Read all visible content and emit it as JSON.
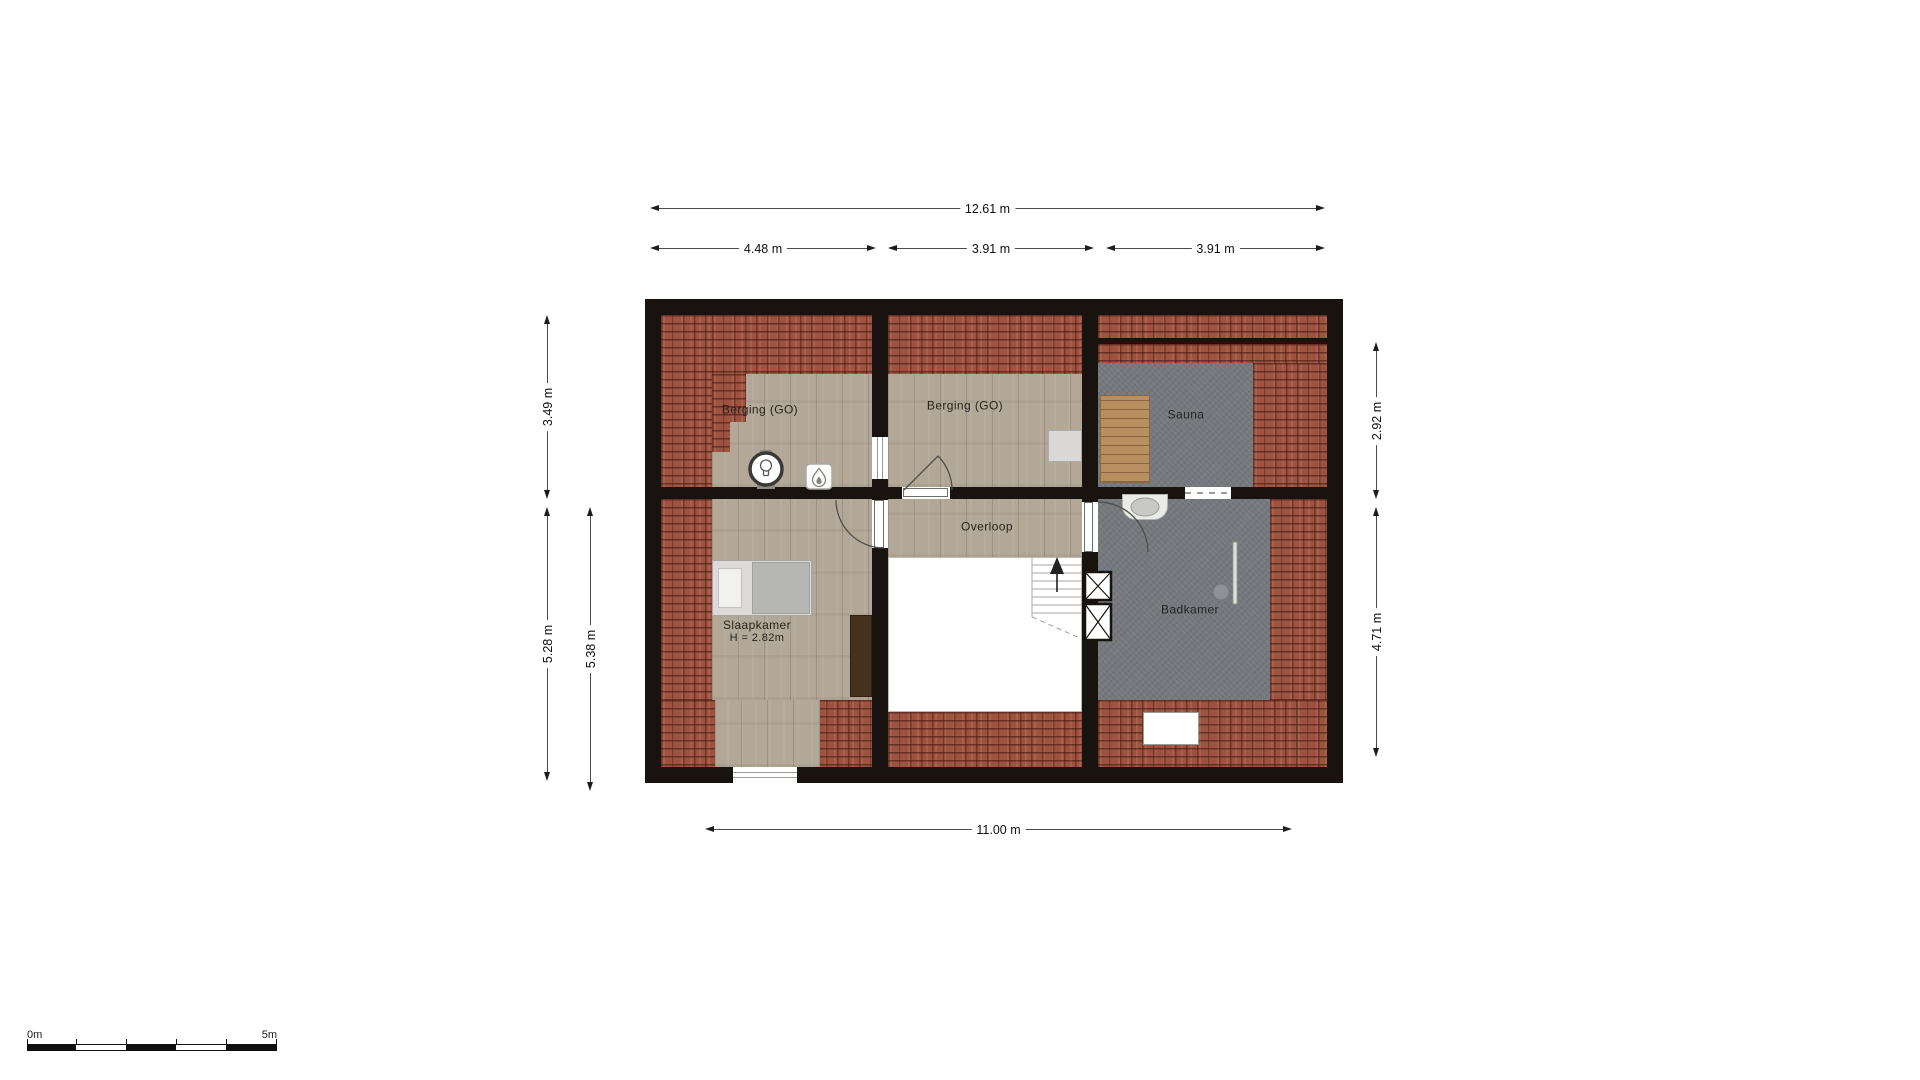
{
  "plan": {
    "type": "floorplan-attic-level",
    "dims": {
      "top_total": "12.61 m",
      "top_seg_1": "4.48 m",
      "top_seg_2": "3.91 m",
      "top_seg_3": "3.91 m",
      "left_1": "3.49 m",
      "left_2": "5.28 m",
      "left_3": "5.38 m",
      "right_1": "2.92 m",
      "right_2": "4.71 m",
      "bottom": "11.00 m"
    },
    "rooms": {
      "berging_left": "Berging (GO)",
      "berging_mid": "Berging (GO)",
      "sauna": "Sauna",
      "overloop": "Overloop",
      "slaapkamer": "Slaapkamer",
      "slaapkamer_height": "H = 2.82m",
      "badkamer": "Badkamer"
    },
    "scale_bar": {
      "start_label": "0m",
      "end_label": "5m"
    },
    "icons": [
      "mech-vent-unit-icon",
      "boiler-flame-icon",
      "stairs-up-arrow-icon",
      "washbasin-icon",
      "shower-icon",
      "duct-shaft-x-icon"
    ],
    "colors": {
      "wall": "#18130f",
      "roof_tiles": "#9d5340",
      "wood_floor": "#b3a898",
      "wet_room_floor": "#75787c",
      "sauna_bench": "#b78f60",
      "dimension_line": "#4a4a4a"
    }
  }
}
